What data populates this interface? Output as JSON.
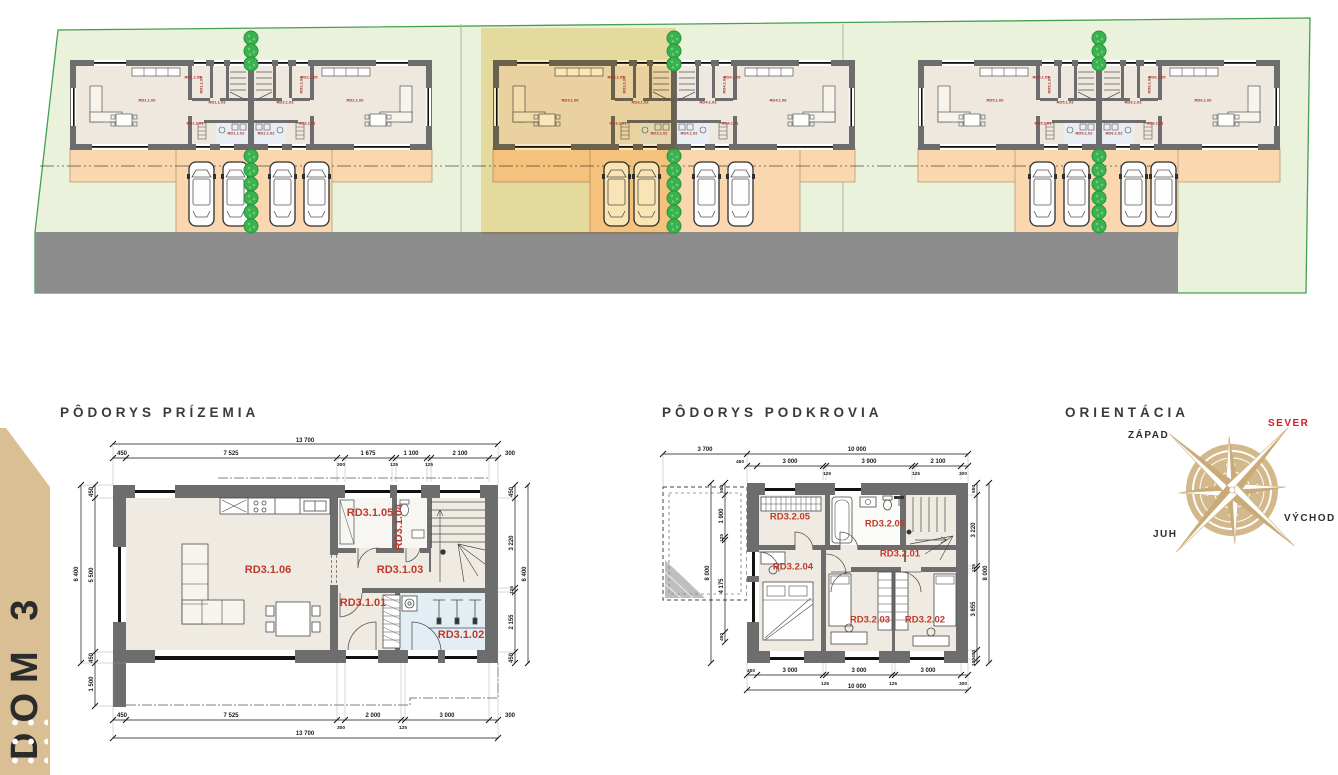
{
  "banner": {
    "label": "DOM 3"
  },
  "site_plan": {
    "units": [
      {
        "id": "RD1",
        "labels": {
          "living": "RD1.1.06",
          "top": "RD1.1.05",
          "wc": "RD1.1.04",
          "hall": "RD1.1.03",
          "entry": "RD1.1.01",
          "bath": "RD1.1.02"
        }
      },
      {
        "id": "RD2",
        "labels": {
          "living": "RD2.1.06",
          "top": "RD2.1.05",
          "wc": "RD2.1.04",
          "hall": "RD2.1.03",
          "entry": "RD2.1.01",
          "bath": "RD2.1.02"
        }
      },
      {
        "id": "RD3",
        "labels": {
          "living": "RD3.1.06",
          "top": "RD3.1.05",
          "wc": "RD3.1.04",
          "hall": "RD3.1.03",
          "entry": "RD3.1.01",
          "bath": "RD3.1.02"
        }
      },
      {
        "id": "RD4",
        "labels": {
          "living": "RD4.1.06",
          "top": "RD4.1.05",
          "wc": "RD4.1.04",
          "hall": "RD4.1.03",
          "entry": "RD4.1.01",
          "bath": "RD4.1.02"
        }
      },
      {
        "id": "RD5",
        "labels": {
          "living": "RD5.1.06",
          "top": "RD5.1.05",
          "wc": "RD5.1.04",
          "hall": "RD5.1.03",
          "entry": "RD5.1.01",
          "bath": "RD5.1.02"
        }
      },
      {
        "id": "RD6",
        "labels": {
          "living": "RD6.1.06",
          "top": "RD6.1.05",
          "wc": "RD6.1.04",
          "hall": "RD6.1.03",
          "entry": "RD6.1.01",
          "bath": "RD6.1.02"
        }
      }
    ]
  },
  "ground_floor": {
    "title": "PÔDORYS PRÍZEMIA",
    "rooms": {
      "r01": "RD3.1.01",
      "r02": "RD3.1.02",
      "r03": "RD3.1.03",
      "r04": "RD3.1.04",
      "r05": "RD3.1.05",
      "r06": "RD3.1.06"
    },
    "dims": {
      "top_total": "13 700",
      "top_chain": [
        "450",
        "7 525",
        "1 675",
        "1 100",
        "2 100",
        "300"
      ],
      "top_sub": [
        "300",
        "125",
        "125"
      ],
      "left_outer": "6 400",
      "left_chain": [
        "450",
        "5 500",
        "450"
      ],
      "left_below": "1 500",
      "right_chain": [
        "450",
        "3 220",
        "125",
        "2 155",
        "450"
      ],
      "right_outer": "6 400",
      "bottom_chain": [
        "450",
        "7 525",
        "2 000",
        "3 000",
        "300"
      ],
      "bottom_sub": [
        "300",
        "125"
      ],
      "bottom_total": "13 700"
    }
  },
  "attic": {
    "title": "PÔDORYS PODKROVIA",
    "rooms": {
      "r01": "RD3.2.01",
      "r02": "RD3.2.02",
      "r03": "RD3.2.03",
      "r04": "RD3.2.04",
      "r05": "RD3.2.05",
      "r06": "RD3.2.06"
    },
    "dims": {
      "terrace_width": "3 700",
      "top_total": "10 000",
      "top_chain": [
        "450",
        "3 000",
        "125",
        "3 900",
        "125",
        "2 100",
        "300"
      ],
      "left_outer": "8 000",
      "left_chain": [
        "550",
        "1 900",
        "125",
        "4 175",
        "450"
      ],
      "right_chain": [
        "550",
        "3 220",
        "125",
        "3 655",
        "400",
        "100"
      ],
      "right_outer": "8 000",
      "bottom_chain": [
        "450",
        "3 000",
        "125",
        "3 000",
        "125",
        "3 000",
        "300"
      ],
      "bottom_sub": [
        "125",
        "125",
        "300"
      ],
      "bottom_total": "10 000"
    }
  },
  "orientation": {
    "title": "ORIENTÁCIA",
    "north": "SEVER",
    "west": "ZÁPAD",
    "east": "VÝCHOD",
    "south": "JUH"
  },
  "colors": {
    "site_green": "#eaf2dc",
    "boundary_green": "#44a04f",
    "road_grey": "#8d8d8d",
    "apron_peach": "#fad7ae",
    "wall_grey": "#6d6d6d",
    "highlight_yellow": "#f6d27c",
    "tree_green": "#3cb14f",
    "bath_blue": "#e2edf4",
    "label_red": "#c0392b",
    "compass_tan": "#d3b88c",
    "north_red": "#d21e1e",
    "banner_tan": "#d9bf93"
  }
}
